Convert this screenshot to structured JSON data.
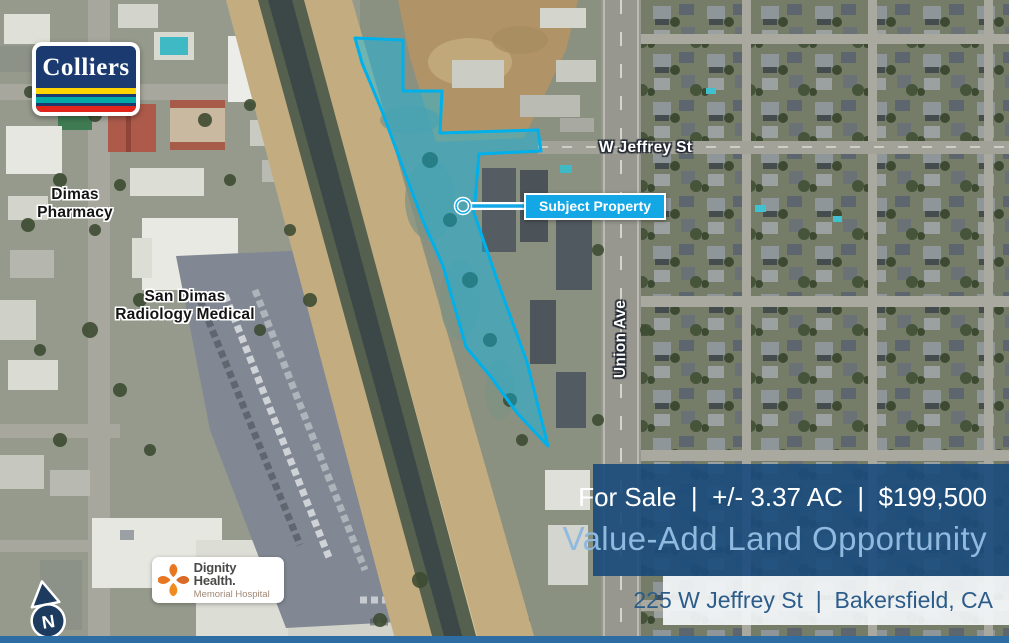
{
  "colors": {
    "property_outline_cyan": "#00AEEF",
    "property_fill_cyan": "rgba(0,188,242,0.42)",
    "banner_navy": "#1B4C7C",
    "headline_light_blue": "#8FB9DE",
    "address_text_navy": "#2C5C8A",
    "bottom_bar_blue": "#2E6DA4",
    "colliers_navy": "#1B3A70",
    "colliers_stripe_yellow": "#FFD400",
    "colliers_stripe_teal": "#00A9A5",
    "colliers_stripe_red": "#E1251B",
    "dignity_orange": "#E87722",
    "callout_blue": "#14A7E5"
  },
  "map": {
    "labels": {
      "pharmacy_line1": "Dimas",
      "pharmacy_line2": "Pharmacy",
      "radiology_line1": "San Dimas",
      "radiology_line2": "Radiology Medical",
      "street_horizontal": "W Jeffrey St",
      "street_vertical": "Union Ave"
    },
    "callout_label": "Subject Property"
  },
  "logos": {
    "colliers_wordmark": "Colliers",
    "dignity_name": "Dignity Health.",
    "dignity_sub": "Memorial Hospital"
  },
  "compass_label": "N",
  "banner": {
    "sale_line": "For Sale  |  +/- 3.37 AC  |  $199,500",
    "headline": "Value-Add Land Opportunity",
    "address": "225 W Jeffrey St  |  Bakersfield, CA"
  }
}
